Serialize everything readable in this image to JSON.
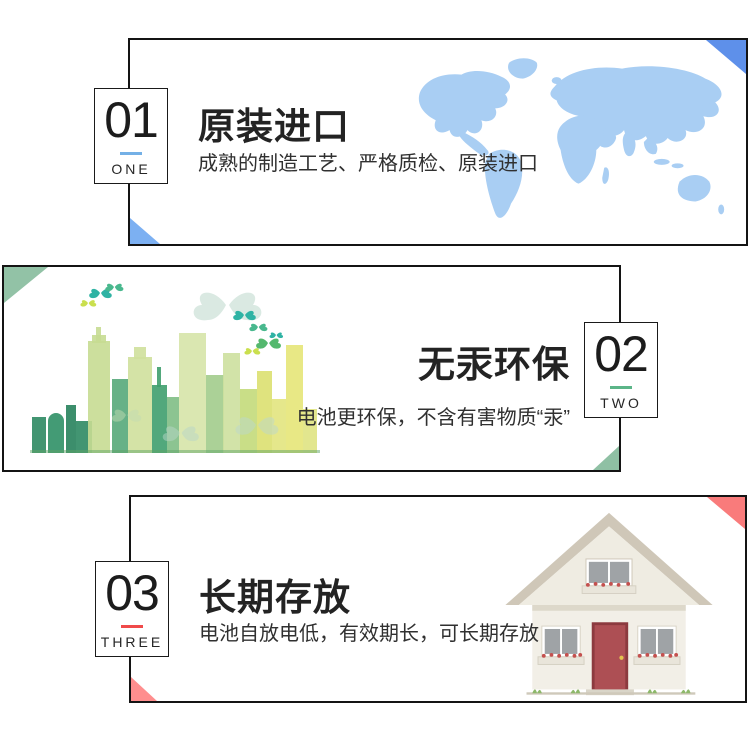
{
  "page": {
    "background": "#ffffff",
    "language": "zh-CN",
    "kind": "product-feature-banner"
  },
  "sections": [
    {
      "badge": {
        "number": "01",
        "word": "ONE",
        "underline_color": "#74b0e6"
      },
      "title": "原装进口",
      "subtitle": "成熟的制造工艺、严格质检、原装进口",
      "illustration": "world-map",
      "map_color": "#a9cef3",
      "corner_colors": {
        "top_right": "#5e90ea",
        "bottom_left": "#7cb0f2"
      }
    },
    {
      "badge": {
        "number": "02",
        "word": "TWO",
        "underline_color": "#5bb588"
      },
      "title": "无汞环保",
      "subtitle": "电池更环保，不含有害物质“汞”",
      "illustration": "green-city-skyline-with-butterflies",
      "corner_colors": {
        "top_left": "#92c2a6",
        "bottom_right": "#8fc0a4"
      }
    },
    {
      "badge": {
        "number": "03",
        "word": "THREE",
        "underline_color": "#f04a4a"
      },
      "title": "长期存放",
      "subtitle": "电池自放电低，有效期长，可长期存放",
      "illustration": "country-house",
      "corner_colors": {
        "top_right": "#f97b7b",
        "bottom_left": "#ff8e8e"
      }
    }
  ]
}
